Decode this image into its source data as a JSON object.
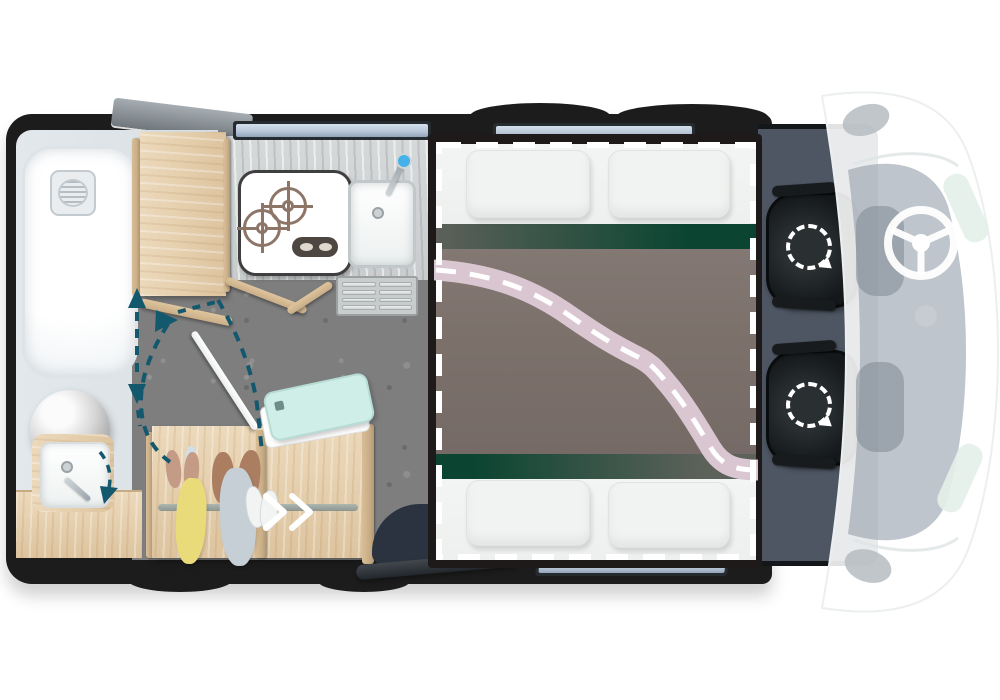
{
  "meta": {
    "title": "Motorhome interior floor plan (top-down)",
    "view": "plan",
    "text_visible": false
  },
  "rooms": [
    {
      "id": "bathroom",
      "label": "washroom with shower tray, toilet dome and washbasin vanity"
    },
    {
      "id": "kitchen",
      "label": "kitchen block with 2-burner hob, sink and entry step grate"
    },
    {
      "id": "wardrobe",
      "label": "wardrobe with hanging rail, clothes and shoes"
    },
    {
      "id": "lounge-bed",
      "label": "rear lounge / twin bed area with drop-down bed outline"
    },
    {
      "id": "cab",
      "label": "driver cab with two swivel seats"
    },
    {
      "id": "vehicle-front",
      "label": "ghosted base-vehicle cab with steering wheel, mirrors and headlights"
    }
  ],
  "annotations": {
    "white_dashed_rectangle": "drop-down bed outline over lounge",
    "pink_dashed_band": "bed conversion / partition path",
    "teal_dashed_arrows": "door swing and sliding-door travel indicators",
    "white_dashed_circles": "cab seat swivel rotation indicators"
  },
  "colors": {
    "wall": "#1c1c1c",
    "window_glass": "#b9c7d8",
    "bathroom_floor": "#d9e0e4",
    "wood_light": "#ecd9bb",
    "wood_mid": "#ddc49f",
    "wood_edge": "#c9ae87",
    "counter_gray": "#c9cccd",
    "hob_outline": "#3f3f3f",
    "burner": "#8d7668",
    "knob_panel": "#4e4741",
    "faucet_dot": "#45b1e8",
    "floor_concrete": "#7e7e7e",
    "bed_frame": "#1d1a19",
    "bedding_white": "#eef0ef",
    "bed_base_taupe": "#7c716b",
    "green_dark": "#0b4531",
    "green_fade": "#5c615a",
    "pink_band": "#d9c6d0",
    "cab_floor": "#4e5663",
    "windshield": "#97a1ac",
    "headlight": "#e4efe9",
    "mirror_gray": "#b6bcc1",
    "teal_arrow": "#14586e",
    "tablet_mint": "#cfeee7",
    "entry_dark": "#2b3240",
    "shoe_brown": "#ab7e62",
    "shoe_tan": "#c49b85",
    "jacket_yellow": "#e9da7a",
    "jacket_gray": "#c6cfd6"
  }
}
